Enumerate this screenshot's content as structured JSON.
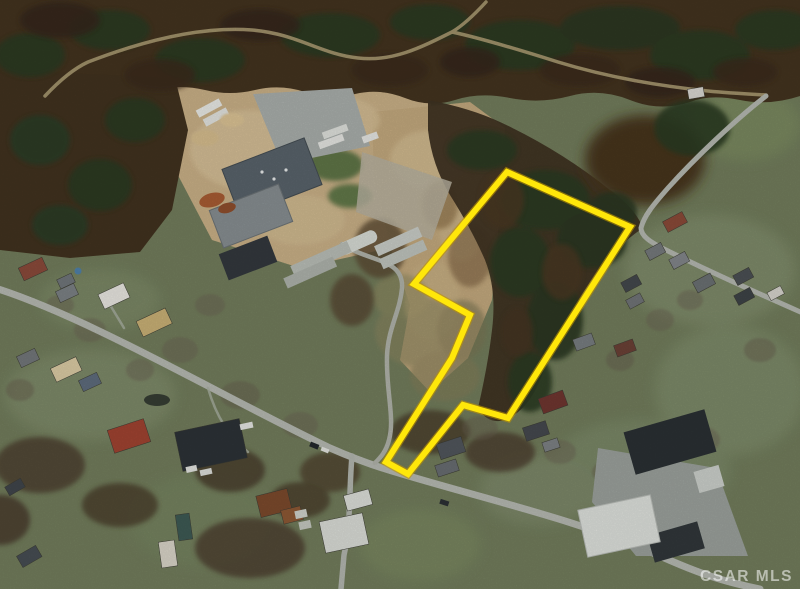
{
  "image": {
    "kind": "satellite-aerial-photo",
    "description": "Aerial MLS listing photo of a vacant land parcel outlined in yellow, bordered by a wooded hillside, an industrial lumber complex to the northwest, and residential streets with lawns and houses to the south and east",
    "width": 800,
    "height": 589
  },
  "property_boundary": {
    "color": "#ffe70a",
    "outline_color": "#bf9400",
    "stroke_width": 6,
    "points": [
      [
        507,
        172
      ],
      [
        630,
        227
      ],
      [
        508,
        418
      ],
      [
        463,
        405
      ],
      [
        408,
        474
      ],
      [
        386,
        462
      ],
      [
        452,
        358
      ],
      [
        470,
        315
      ],
      [
        414,
        284
      ]
    ]
  },
  "watermark": {
    "text": "CSAR MLS",
    "color": "rgba(255,255,255,0.55)"
  }
}
